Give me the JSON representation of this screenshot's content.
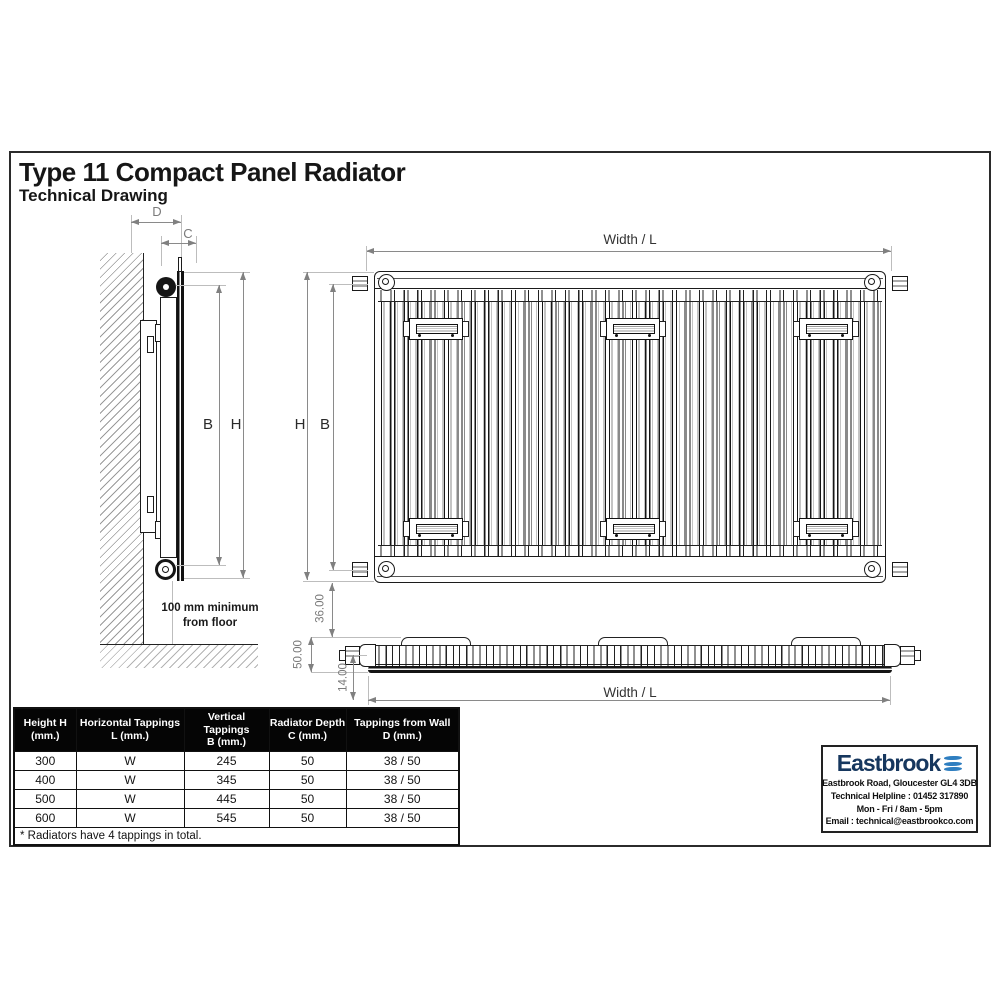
{
  "title": "Type 11 Compact Panel Radiator",
  "subtitle": "Technical Drawing",
  "side_view": {
    "dim_d": "D",
    "dim_c": "C",
    "dim_b": "B",
    "dim_h": "H",
    "floor_note_line1": "100 mm minimum",
    "floor_note_line2": "from floor"
  },
  "front_view": {
    "width_label": "Width / L",
    "dim_h": "H",
    "dim_b": "B"
  },
  "top_view": {
    "dim_depth_36": "36.00",
    "dim_depth_50": "50.00",
    "dim_depth_14": "14.00",
    "width_label": "Width / L"
  },
  "table": {
    "headers": [
      {
        "line1": "Height H",
        "line2": "(mm.)"
      },
      {
        "line1": "Horizontal Tappings",
        "line2": "L (mm.)"
      },
      {
        "line1": "Vertical Tappings",
        "line2": "B (mm.)"
      },
      {
        "line1": "Radiator Depth",
        "line2": "C (mm.)"
      },
      {
        "line1": "Tappings from Wall",
        "line2": "D (mm.)"
      }
    ],
    "rows": [
      [
        "300",
        "W",
        "245",
        "50",
        "38 / 50"
      ],
      [
        "400",
        "W",
        "345",
        "50",
        "38 / 50"
      ],
      [
        "500",
        "W",
        "445",
        "50",
        "38 / 50"
      ],
      [
        "600",
        "W",
        "545",
        "50",
        "38 / 50"
      ]
    ],
    "footnote": "* Radiators have 4 tappings in total."
  },
  "brand": {
    "name": "Eastbrook",
    "address": "Eastbrook Road, Gloucester GL4 3DB",
    "helpline": "Technical Helpline : 01452 317890",
    "hours": "Mon - Fri / 8am - 5pm",
    "email": "Email : technical@eastbrookco.com",
    "logo_color": "#16375e",
    "wave_color": "#2e7ec0"
  }
}
